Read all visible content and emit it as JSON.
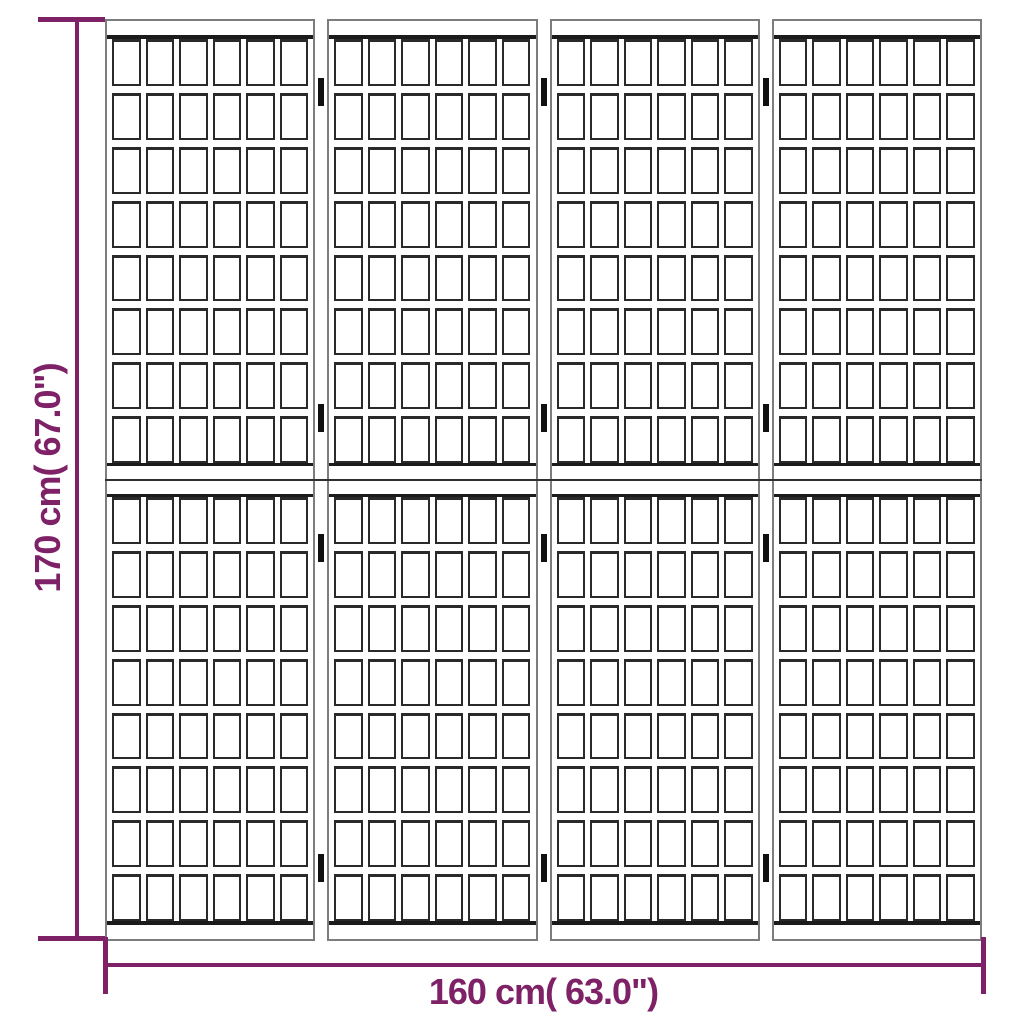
{
  "screen": {
    "panel_count": 4,
    "columns_per_panel": 6,
    "rows_per_half": 8,
    "halves_per_panel": 2,
    "hinge_tops": [
      59,
      385,
      515,
      835
    ]
  },
  "annotations": {
    "height_label": "170 cm( 67.0\")",
    "width_label": "160 cm( 63.0\")"
  },
  "colors": {
    "dimension_accent": "#7e2166",
    "frame_gray": "#7d7d7d",
    "slat_dark": "#2a2a2a",
    "rail_dark": "#1b1b1b",
    "hinge_black": "#101010",
    "background": "#ffffff"
  }
}
